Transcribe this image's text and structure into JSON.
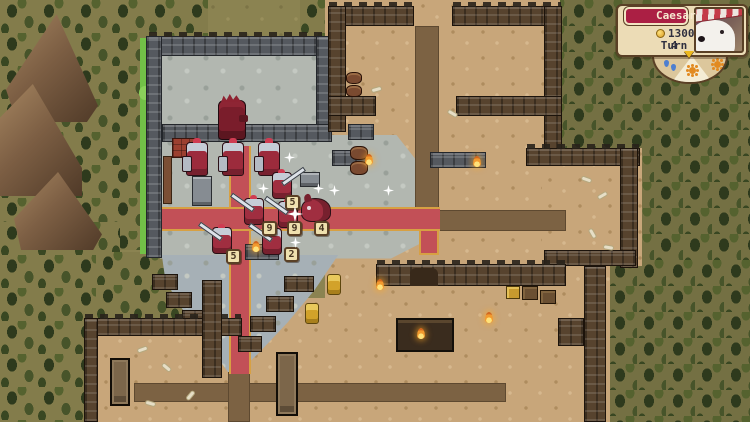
{
  "hud": {
    "player_name": "Caesar",
    "gold_amount": "1300",
    "turn_label": "Turn",
    "turn_number": "4",
    "weather_icons": [
      "rain",
      "sun",
      "sun"
    ]
  },
  "map_state": {
    "red_units": [
      {
        "type": "commander",
        "x": 218,
        "y": 100
      },
      {
        "type": "swordsman",
        "x": 186,
        "y": 142
      },
      {
        "type": "swordsman",
        "x": 222,
        "y": 142
      },
      {
        "type": "swordsman",
        "x": 258,
        "y": 142
      },
      {
        "type": "pikeman",
        "x": 272,
        "y": 172,
        "facing": "right",
        "badge": "5",
        "bx": 285,
        "by": 195
      },
      {
        "type": "pikeman",
        "x": 244,
        "y": 198,
        "facing": "left",
        "badge": "9",
        "bx": 262,
        "by": 221
      },
      {
        "type": "pikeman",
        "x": 278,
        "y": 201,
        "facing": "left",
        "badge": "9",
        "bx": 287,
        "by": 221
      },
      {
        "type": "dog",
        "x": 301,
        "y": 198,
        "badge": "4",
        "bx": 314,
        "by": 221
      },
      {
        "type": "pikeman",
        "x": 262,
        "y": 228,
        "facing": "left",
        "badge": "2",
        "bx": 284,
        "by": 247
      },
      {
        "type": "pikeman",
        "x": 212,
        "y": 227,
        "facing": "left",
        "badge": "5",
        "bx": 226,
        "by": 249
      }
    ],
    "gold_units": [
      {
        "x": 327,
        "y": 274
      },
      {
        "x": 305,
        "y": 303
      }
    ],
    "stars": [
      {
        "x": 284,
        "y": 152
      },
      {
        "x": 258,
        "y": 183
      },
      {
        "x": 313,
        "y": 183
      },
      {
        "x": 329,
        "y": 185
      },
      {
        "x": 383,
        "y": 185
      },
      {
        "x": 287,
        "y": 206,
        "size": 16
      },
      {
        "x": 290,
        "y": 237
      }
    ],
    "flames": [
      {
        "x": 365,
        "y": 154
      },
      {
        "x": 473,
        "y": 156
      },
      {
        "x": 252,
        "y": 241
      },
      {
        "x": 376,
        "y": 279
      },
      {
        "x": 485,
        "y": 312
      },
      {
        "x": 417,
        "y": 328
      }
    ],
    "bones": [
      {
        "x": 582,
        "y": 178,
        "r": 20
      },
      {
        "x": 598,
        "y": 194,
        "r": -30
      },
      {
        "x": 588,
        "y": 232,
        "r": 60
      },
      {
        "x": 604,
        "y": 246,
        "r": 10
      },
      {
        "x": 138,
        "y": 348,
        "r": -20
      },
      {
        "x": 162,
        "y": 366,
        "r": 40
      },
      {
        "x": 186,
        "y": 394,
        "r": -50
      },
      {
        "x": 146,
        "y": 402,
        "r": 15
      },
      {
        "x": 448,
        "y": 112,
        "r": 30
      },
      {
        "x": 372,
        "y": 88,
        "r": -15
      }
    ]
  },
  "palette": {
    "ground": "#8b8351",
    "forest": "#3c4823",
    "stone_floor": "#b2b7b0",
    "stone_wall": "#55595f",
    "sand": "#c8a67a",
    "brown_wall": "#57432e",
    "red_road": "#c25057",
    "road_edge": "#d7a043",
    "unit_red": "#9c2b3c",
    "gold_unit": "#d2a22a",
    "hud_panel": "#ecdcb6",
    "hud_banner": "#ab1f44"
  }
}
